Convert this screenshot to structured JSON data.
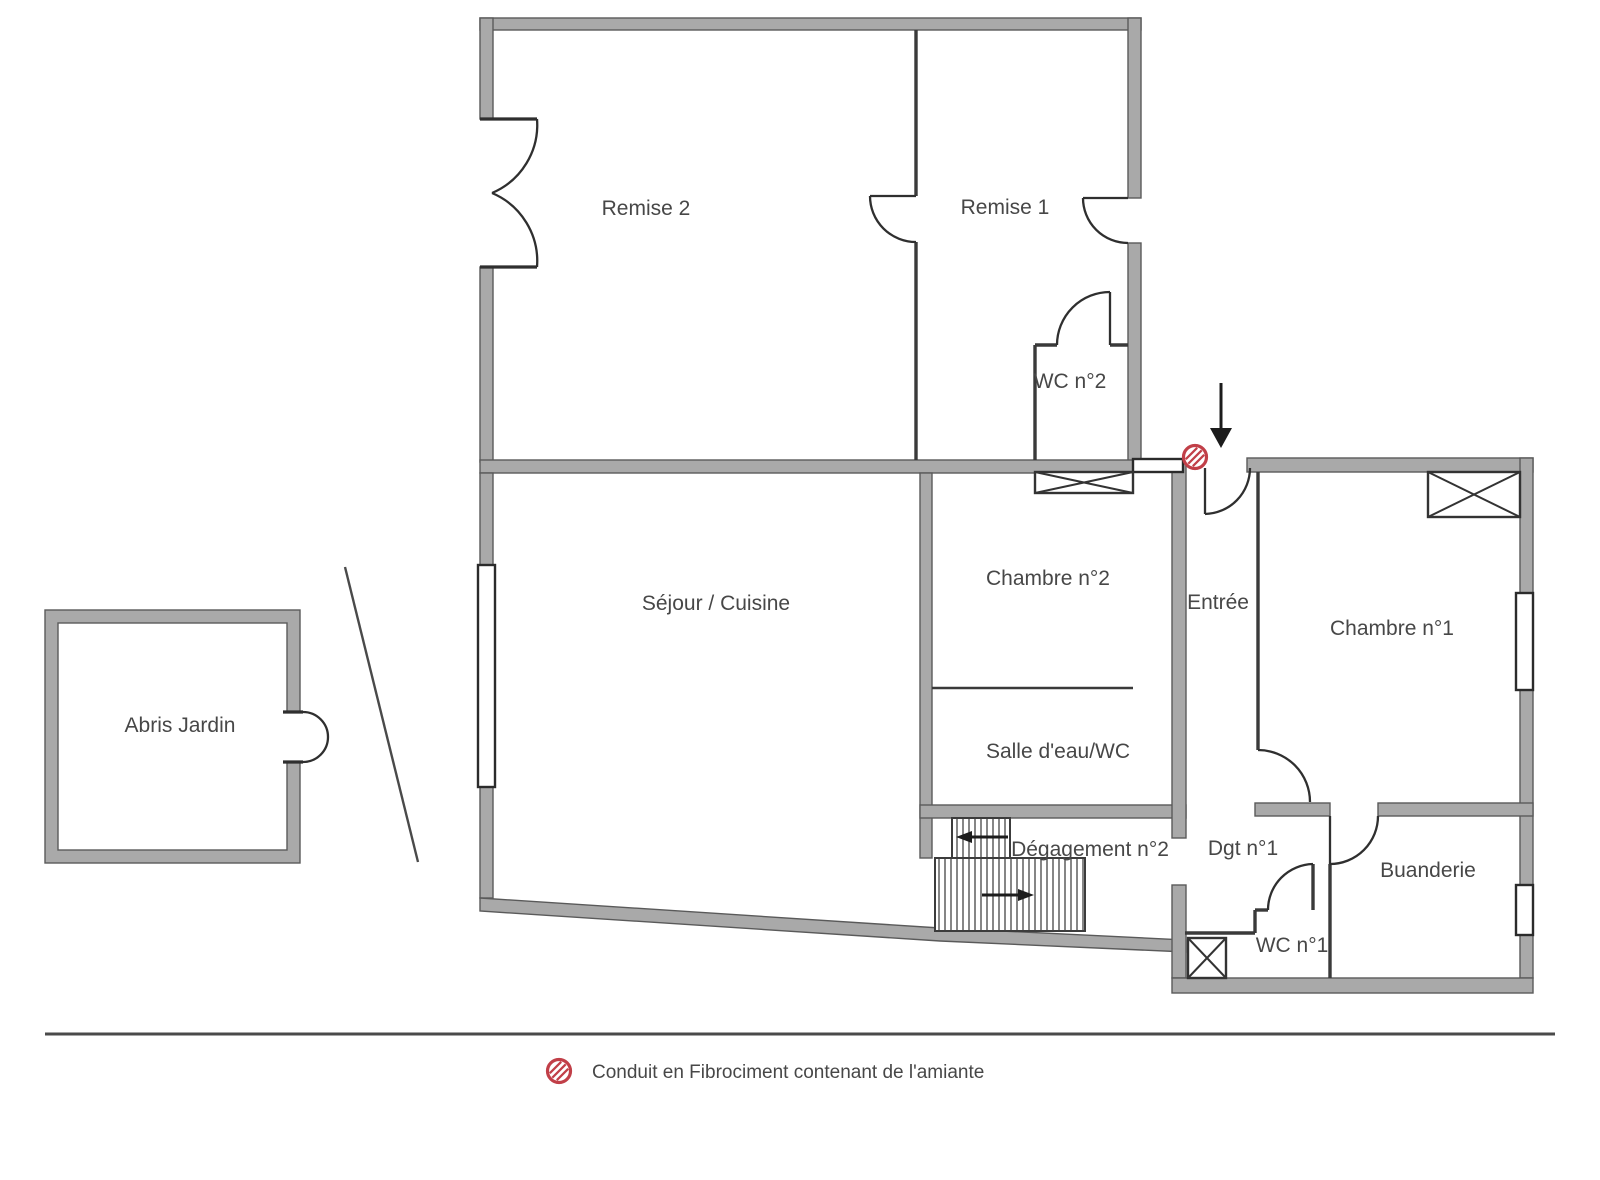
{
  "rooms": {
    "remise_2": "Remise 2",
    "remise_1": "Remise 1",
    "wc_2": "WC n°2",
    "sejour_cuisine": "Séjour / Cuisine",
    "chambre_2": "Chambre n°2",
    "entree": "Entrée",
    "chambre_1": "Chambre n°1",
    "salle_eau_wc": "Salle d'eau/WC",
    "degagement_2": "Dégagement n°2",
    "dgt_1": "Dgt n°1",
    "buanderie": "Buanderie",
    "wc_1": "WC n°1",
    "abris_jardin": "Abris Jardin"
  },
  "legend": {
    "asbestos_conduit": "Conduit en Fibrociment contenant de l'amiante"
  },
  "icons": {
    "asbestos_symbol": "red hatched circle",
    "entrance_arrow": "black down arrow",
    "stairs_up_arrow": "left arrow",
    "stairs_down_arrow": "right arrow"
  },
  "colors": {
    "wall_fill": "#a9a9a9",
    "wall_edge": "#5a5a5a",
    "line": "#3a3a3a",
    "text_color": "#474747",
    "asbestos_red": "#c13f48",
    "background": "#ffffff"
  }
}
